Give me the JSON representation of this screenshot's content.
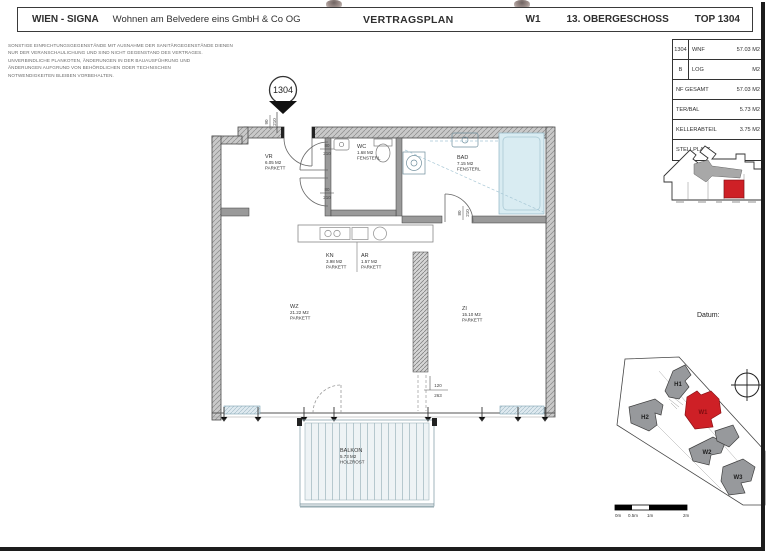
{
  "header": {
    "brand": "WIEN - SIGNA",
    "company": "Wohnen am Belvedere eins GmbH & Co OG",
    "title": "VERTRAGSPLAN",
    "building": "W1",
    "floor": "13. OBERGESCHOSS",
    "unit": "TOP 1304"
  },
  "disclaimer": {
    "line1": "SONSTIGE EINRICHTUNGSGEGENSTÄNDE MIT AUSNAHME DER SANITÄRGEGENSTÄNDE DIENEN",
    "line2": "NUR DER VERANSCHAULICHUNG UND SIND NICHT GEGENSTAND DES VERTRAGES.",
    "line3": "UNVERBINDLICHE PLANKOTEN, ÄNDERUNGEN IN DER BAUAUSFÜHRUNG UND",
    "line4": "ÄNDERUNGEN AUFGRUND VON BEHÖRDLICHEN ODER TECHNISCHEN",
    "line5": "NOTWENDIGKEITEN BLEIBEN VORBEHALTEN."
  },
  "area_table": {
    "rows": [
      {
        "prefix": "1304",
        "label": "WNF",
        "value": "57.03 M2"
      },
      {
        "prefix": "B",
        "label": "LOG",
        "value": "M2"
      },
      {
        "prefix": "",
        "label": "NF GESAMT",
        "value": "57.03 M2"
      },
      {
        "prefix": "",
        "label": "TER/BAL",
        "value": "5.73 M2"
      },
      {
        "prefix": "",
        "label": "KELLERABTEIL",
        "value": "3.75 M2"
      },
      {
        "prefix": "",
        "label": "STELLPLATZ",
        "value": ""
      }
    ]
  },
  "plan": {
    "unit_marker": "1304",
    "rooms": [
      {
        "name": "VR",
        "area": "6.05 M2",
        "finish": "PARKETT"
      },
      {
        "name": "WC",
        "area": "1.68 M2",
        "finish": "FENSTERL"
      },
      {
        "name": "BAD",
        "area": "7.15 M2",
        "finish": "FENSTERL"
      },
      {
        "name": "KN",
        "area": "3.98 M2",
        "finish": "PARKETT"
      },
      {
        "name": "AR",
        "area": "1.57 M2",
        "finish": "PARKETT"
      },
      {
        "name": "WZ",
        "area": "21.22 M2",
        "finish": "PARKETT"
      },
      {
        "name": "ZI",
        "area": "15.10 M2",
        "finish": "PARKETT"
      },
      {
        "name": "BALKON",
        "area": "5.73 M2",
        "finish": "HOLZROST"
      }
    ],
    "dims": {
      "entrance_w": "90",
      "entrance_h": "210",
      "wc_w": "80",
      "wc_h": "210",
      "hall_w": "80",
      "hall_h": "210",
      "bad_w": "80",
      "bad_h": "210",
      "passage_w": "120",
      "passage_h": "263"
    }
  },
  "right_panel": {
    "datum_label": "Datum:",
    "site_labels": {
      "h1": "H1",
      "h2": "H2",
      "w1": "W1",
      "w2": "W2",
      "w3": "W3"
    },
    "scalebar_ticks": [
      "0m",
      "0.5m",
      "1m",
      "2m"
    ]
  },
  "colors": {
    "highlight_red": "#ce2026",
    "building_gray": "#97999c",
    "wall_gray": "#c9c9c9",
    "fixture_blue": "#d9ecf2"
  }
}
